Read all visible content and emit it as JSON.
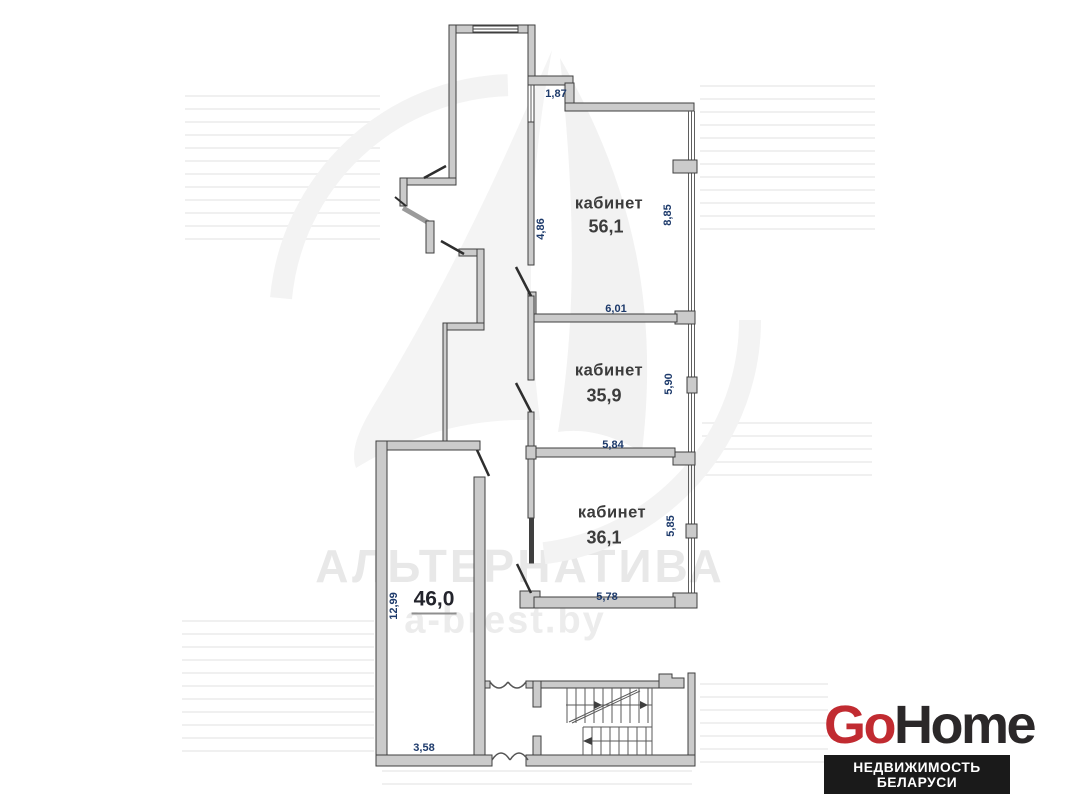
{
  "plan": {
    "rooms": [
      {
        "id": "room-1",
        "label": "кабинет",
        "area": "56,1"
      },
      {
        "id": "room-2",
        "label": "кабинет",
        "area": "35,9"
      },
      {
        "id": "room-3",
        "label": "кабинет",
        "area": "36,1"
      },
      {
        "id": "room-4",
        "label": "",
        "area": "46,0"
      }
    ],
    "dimensions": {
      "shaft_top": "1,87",
      "room1_left": "4,86",
      "room1_right": "8,85",
      "room2_top": "6,01",
      "room2_right": "5,90",
      "room2_bottom": "5,84",
      "room3_right": "5,85",
      "room3_bottom": "5,78",
      "room4_left": "12,99",
      "room4_bottom": "3,58"
    },
    "features": [
      "staircase",
      "door-swings",
      "windows"
    ]
  },
  "watermark": {
    "brand": "АЛЬТЕРНАТИВА",
    "site": "a-brest.by"
  },
  "logo": {
    "go": "Go",
    "home": "Home",
    "tagline": "НЕДВИЖИМОСТЬ БЕЛАРУСИ"
  },
  "colors": {
    "dimension_text": "#1d3a6b",
    "room_text": "#3c3c3c",
    "wall_fill": "#cbcbcb",
    "wall_outline": "#3f3f3f",
    "logo_red": "#c12b31",
    "logo_dark": "#2b2829",
    "tagline_bg": "#1a1a1a",
    "watermark_gray": "#e8e8e8"
  }
}
